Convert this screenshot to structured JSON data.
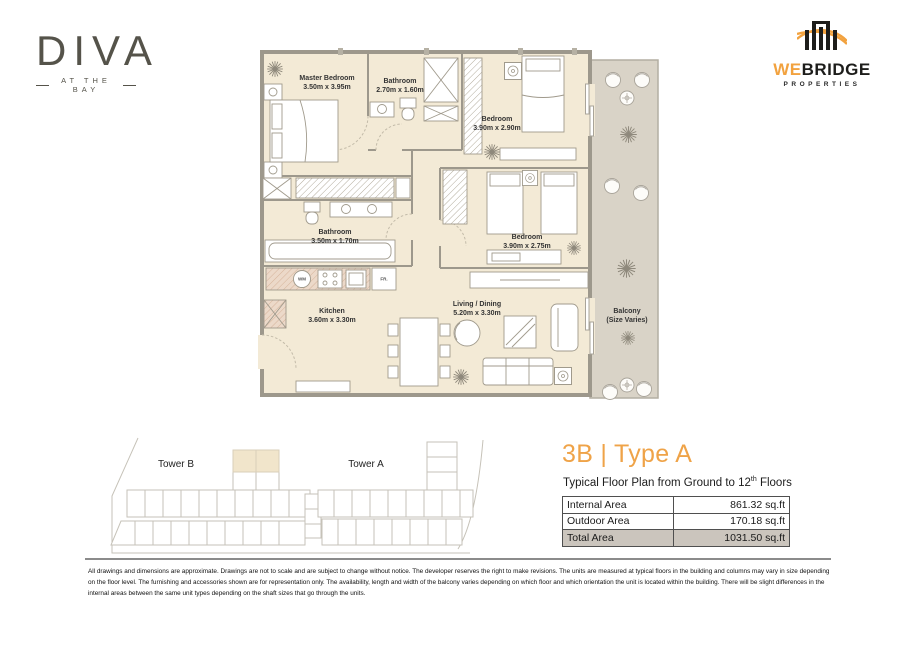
{
  "header": {
    "diva": {
      "name": "DIVA",
      "tagline": "AT THE BAY"
    },
    "webridge": {
      "we": "WE",
      "bridge": "BRIDGE",
      "properties": "PROPERTIES"
    }
  },
  "floorplan": {
    "rooms": [
      {
        "name": "Master Bedroom",
        "dims": "3.50m x 3.95m"
      },
      {
        "name": "Bathroom",
        "dims": "2.70m x 1.60m"
      },
      {
        "name": "Bedroom",
        "dims": "3.90m x 2.90m"
      },
      {
        "name": "Bathroom",
        "dims": "3.50m x 1.70m"
      },
      {
        "name": "Bedroom",
        "dims": "3.90m x 2.75m"
      },
      {
        "name": "Kitchen",
        "dims": "3.60m x 3.30m"
      },
      {
        "name": "Living / Dining",
        "dims": "5.20m x 3.30m"
      },
      {
        "name": "Balcony",
        "dims": "(Size Varies)"
      }
    ],
    "appliances": {
      "wm": "WM",
      "fr": "FR."
    }
  },
  "keyplan": {
    "tower_b": "Tower B",
    "tower_a": "Tower A"
  },
  "unit_info": {
    "title": "3B | Type A",
    "subtitle_prefix": "Typical Floor Plan from Ground to 12",
    "subtitle_sup": "th",
    "subtitle_suffix": " Floors",
    "table": {
      "rows": [
        {
          "label": "Internal Area",
          "value": "861.32 sq.ft"
        },
        {
          "label": "Outdoor Area",
          "value": "170.18 sq.ft"
        },
        {
          "label": "Total Area",
          "value": "1031.50 sq.ft"
        }
      ]
    }
  },
  "disclaimer": "All drawings and dimensions are approximate. Drawings are not to scale and are subject to change without notice. The developer reserves the right to make revisions. The units are measured at typical floors in the building and columns may vary in size depending on the floor level. The furnishing and accessories shown are for representation only. The availability, length and width of the balcony varies depending on which floor and which orientation the unit is located within the building. There will be slight differences in the internal areas between the same unit types depending on the shaft sizes that go through the units.",
  "colors": {
    "accent": "#EFA348",
    "room_fill": "#F3EAD6",
    "balcony_fill": "#D9D3C7",
    "logo": "#55534A",
    "total_row_bg": "#CBC5BD"
  }
}
